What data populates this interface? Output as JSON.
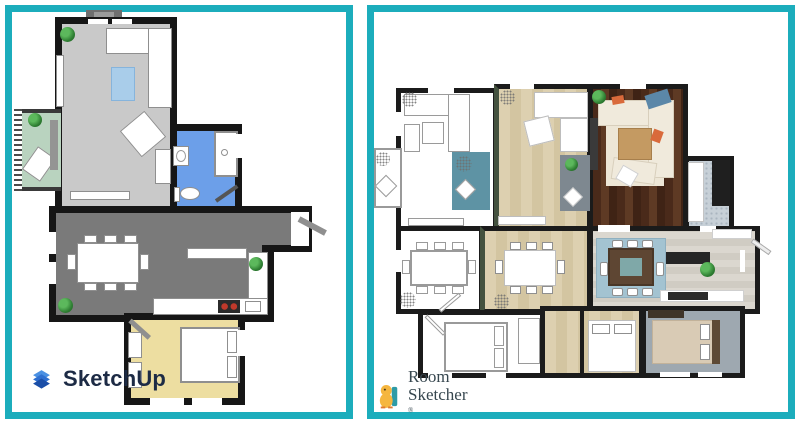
{
  "page": {
    "background": "#ffffff",
    "accent_border_color": "#1CADBC",
    "description": "Side-by-side comparison of two 2D floor plans"
  },
  "left_panel": {
    "brand": "SketchUp",
    "brand_color": "#1D2B45",
    "logo_icon": "sketchup-cube-icon",
    "wall_color": "#161616",
    "rooms": [
      {
        "name": "living-room",
        "floor_color": "#C9C9C9"
      },
      {
        "name": "balcony",
        "floor_color": "#B9D3BF"
      },
      {
        "name": "bathroom",
        "floor_color": "#6C9FE9"
      },
      {
        "name": "kitchen-dining-hall",
        "floor_color": "#7A7A7A"
      },
      {
        "name": "bedroom",
        "floor_color": "#EDDEA1"
      }
    ]
  },
  "right_panel": {
    "brand_line1": "Room",
    "brand_line2": "Sketcher",
    "brand_mark": "®",
    "brand_color": "#37474F",
    "logo_icon": "roomsketcher-mascot-icon",
    "wall_color": "#1b1b1b",
    "rooms": [
      {
        "name": "lounge",
        "floor_color": "#ffffff"
      },
      {
        "name": "family-room",
        "floor_color": "#DCCFAE"
      },
      {
        "name": "living-room",
        "floor_color": "#52301E"
      },
      {
        "name": "bathroom",
        "floor_color": "#C7D0D7"
      },
      {
        "name": "dining-room",
        "floor_color": "#ffffff"
      },
      {
        "name": "dining-room-2",
        "floor_color": "#DCCFAE"
      },
      {
        "name": "kitchen",
        "floor_color": "#DBD7CF"
      },
      {
        "name": "bedroom-1",
        "floor_color": "#ffffff"
      },
      {
        "name": "bedroom-2",
        "floor_color": "#DCCFAE"
      },
      {
        "name": "bedroom-3",
        "floor_color": "#9EA8B0"
      }
    ]
  }
}
